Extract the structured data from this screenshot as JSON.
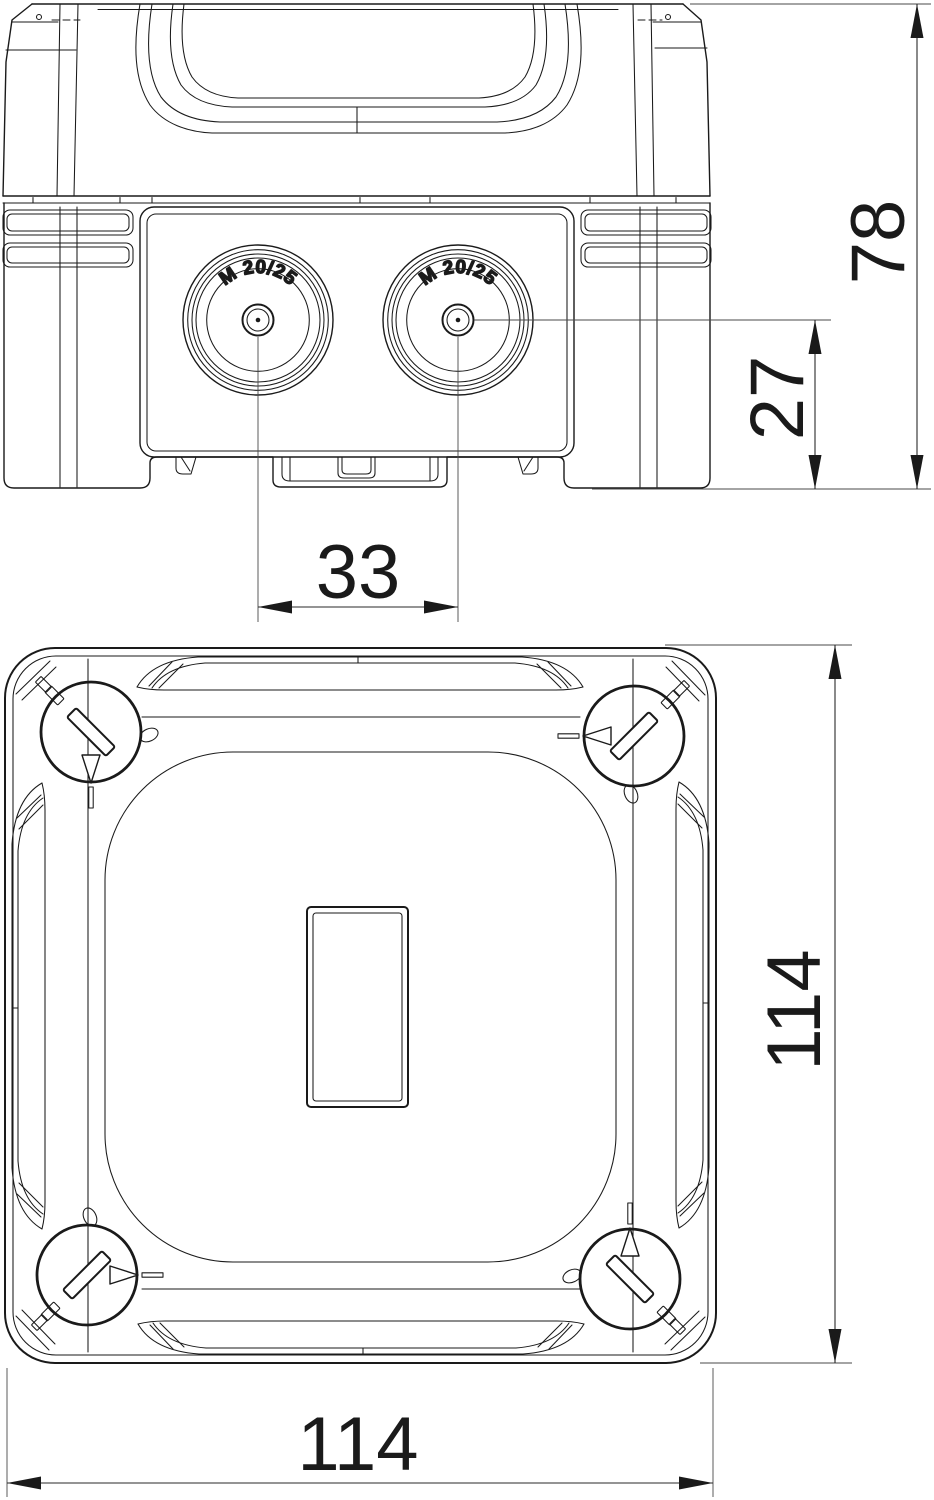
{
  "side_view": {
    "cable_entries": [
      {
        "label": "M 20/25"
      },
      {
        "label": "M 20/25"
      }
    ]
  },
  "dimensions": {
    "overall_height": "78",
    "entry_axis_height": "27",
    "entry_spacing": "33",
    "width": "114",
    "depth": "114"
  },
  "colors": {
    "ink": "#1a1a1a",
    "dim_line": "#2a2a2a",
    "extension_line": "#4a4a4a",
    "background": "#ffffff"
  }
}
